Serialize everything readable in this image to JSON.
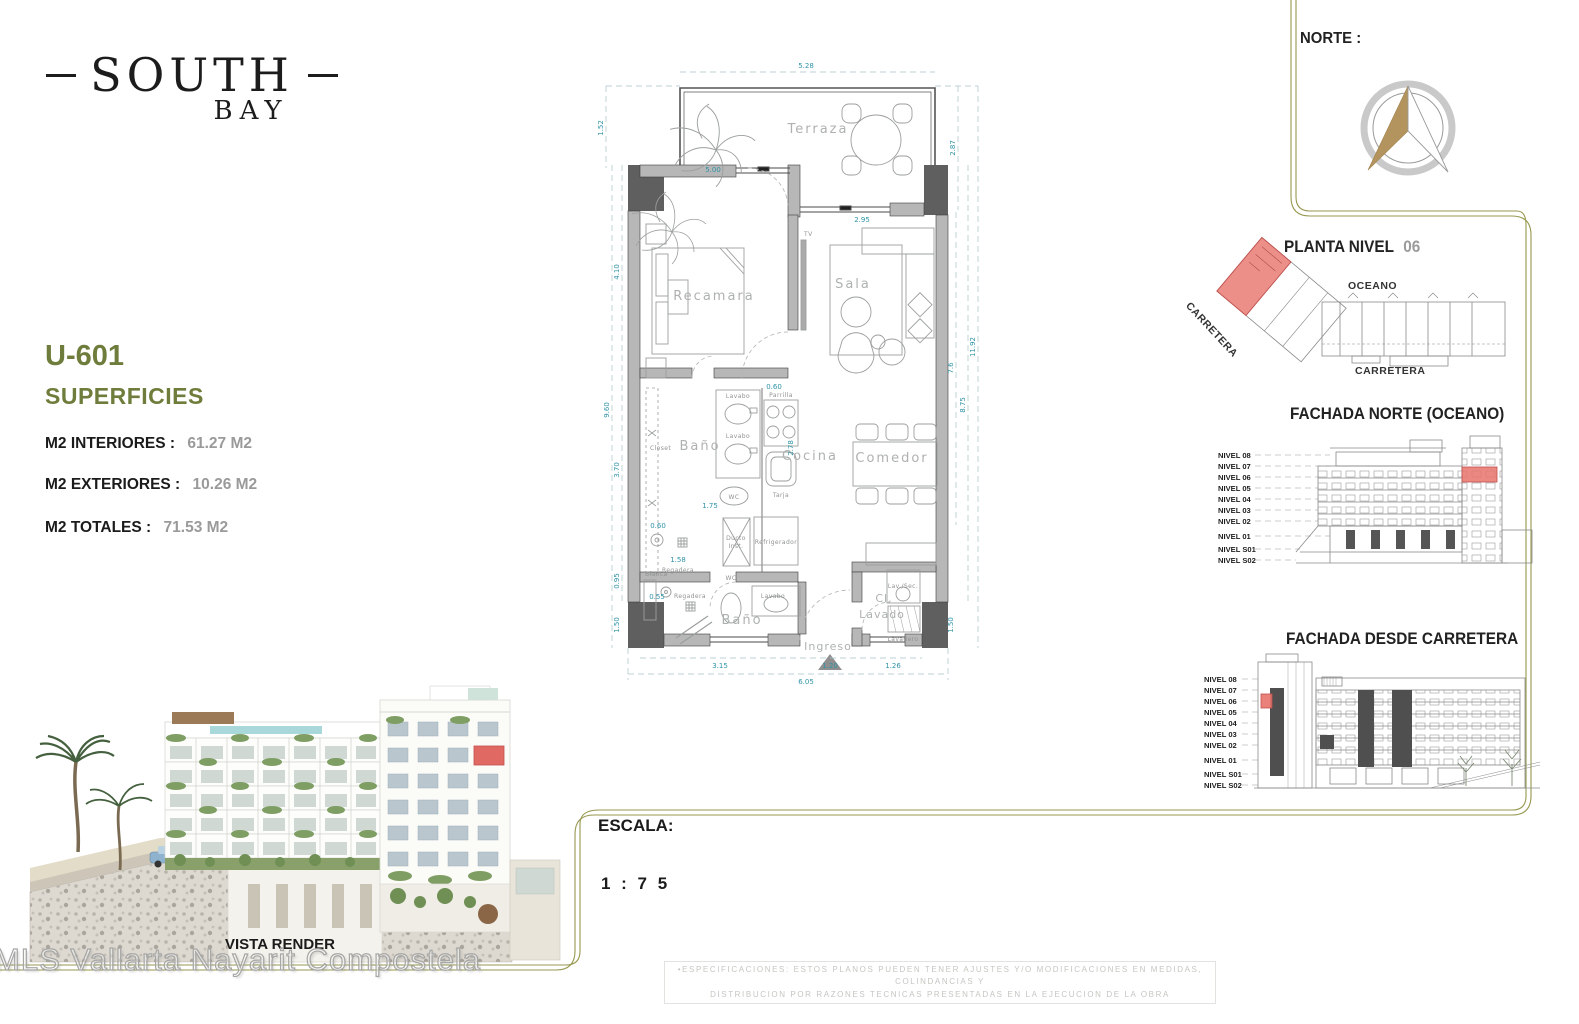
{
  "brand": {
    "line1": "SOUTH",
    "line2": "BAY"
  },
  "unit": {
    "id": "U-601",
    "section": "SUPERFICIES",
    "m2_interiores_label": "M2 INTERIORES :",
    "m2_interiores_value": "61.27  M2",
    "m2_exteriores_label": "M2 EXTERIORES :",
    "m2_exteriores_value": "10.26  M2",
    "m2_totales_label": "M2 TOTALES :",
    "m2_totales_value": "71.53  M2"
  },
  "norte": {
    "label": "NORTE :"
  },
  "planta": {
    "title": "PLANTA  NIVEL",
    "number": "06",
    "oceano": "OCEANO",
    "carretera_diag": "CARRETERA",
    "carretera_bottom": "CARRETERA"
  },
  "fachada_norte": {
    "title": "FACHADA  NORTE  (OCEANO)"
  },
  "fachada_carretera": {
    "title": "FACHADA  DESDE  CARRETERA"
  },
  "levels": [
    "NIVEL 08",
    "NIVEL 07",
    "NIVEL 06",
    "NIVEL 05",
    "NIVEL 04",
    "NIVEL 03",
    "NIVEL 02",
    "NIVEL 01",
    "NIVEL S01",
    "NIVEL S02"
  ],
  "floorplan": {
    "rooms": {
      "terraza": "Terraza",
      "recamara": "Recamara",
      "sala": "Sala",
      "bano1": "Baño",
      "cocina": "Cocina",
      "comedor": "Comedor",
      "bano2": "Baño",
      "ingreso": "Ingreso",
      "cl1": "Cl.",
      "cl2": "Lavado"
    },
    "fix": {
      "tv": "TV",
      "closet": "Closet",
      "lavabo1": "Lavabo",
      "lavabo2": "Lavabo",
      "parrilla": "Parrilla",
      "wc1": "WC",
      "tarja": "Tarja",
      "regadera1": "Regadera",
      "ducto1": "Ducto",
      "ducto2": "Inst.",
      "refrigerador": "Refrigerador",
      "blanca": "Blanca",
      "regadera2": "Regadera",
      "wc2": "WC",
      "lavabo3": "Lavabo",
      "lavsec": "Lav./Sec.",
      "lavadero": "Lavadero"
    },
    "dims": {
      "top": "5.28",
      "terr_h": "1.52",
      "terr_r": "2.87",
      "rec_w": "5.00",
      "sala_w": "2.95",
      "l1": "4.10",
      "l_total": "9.60",
      "l2": "3.70",
      "l3": "0.95",
      "l4": "1.50",
      "r1": "7.6",
      "r2": "8.75",
      "r_total": "11.92",
      "r3": "1.50",
      "i1": "0.60",
      "i2": "1.75",
      "i3": "0.60",
      "i4": "1.58",
      "i5": "0.55",
      "i6": "2.78",
      "b1": "3.15",
      "b2": "1.20",
      "b3": "1.26",
      "b_total": "6.05"
    }
  },
  "escala": {
    "label": "ESCALA:",
    "value": "1 : 7 5"
  },
  "render": {
    "caption": "VISTA RENDER"
  },
  "watermark": "MLS Vallarta Nayarit Compostela",
  "disclaimer": {
    "line1": "•ESPECIFICACIONES:  ESTOS  PLANOS  PUEDEN  TENER  AJUSTES  Y/O  MODIFICACIONES  EN  MEDIDAS, COLINDANCIAS  Y",
    "line2": "DISTRIBUCION  POR  RAZONES  TECNICAS  PRESENTADAS  EN  LA  EJECUCION  DE  LA  OBRA"
  },
  "colors": {
    "olive_text": "#6f7d3c",
    "gold_line": "#97974f",
    "dim_teal": "#2f93a7",
    "highlight_red": "#e8736c",
    "value_gray": "#9a9a9a"
  }
}
